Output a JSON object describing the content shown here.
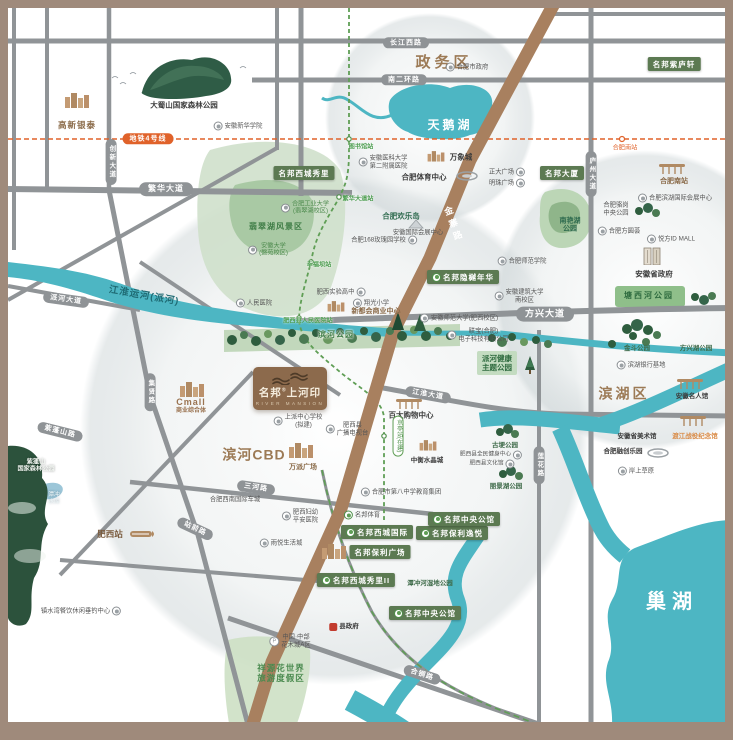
{
  "colors": {
    "frame": "#9f8a7b",
    "water": "#4db6c3",
    "park": "#cfe0cb",
    "tree": "#2e5d3e",
    "road": "#909497",
    "highway_brown": "#a8805f",
    "metro_orange": "#e0622a",
    "metro_green": "#5f9e55",
    "brand_label_green": "#5c7a52",
    "district_brown": "#9c7a55",
    "logo_plate": "#8c6a4c"
  },
  "logo": {
    "brand": "名邦",
    "mark": "®",
    "name": "上河印",
    "en": "RIVER MANSION"
  },
  "pois": [
    {
      "id": "gaoxin-intime-label",
      "t": "高新银泰",
      "x": 77,
      "y": 125,
      "cls": "brown-sm"
    },
    {
      "id": "dashushan-forest-label",
      "t": "大蜀山国家森林公园",
      "x": 184,
      "y": 105,
      "cls": "dark-sm"
    },
    {
      "id": "anhui-xinhua-college-label",
      "t": "安徽新华学院",
      "x": 238,
      "y": 126,
      "cls": "tiny",
      "icon": "p"
    },
    {
      "id": "metro-line4-pill",
      "t": "地铁4号线",
      "x": 148,
      "y": 139,
      "cls": "pill orange sm"
    },
    {
      "id": "fanhua-avenue-pill",
      "t": "繁华大道",
      "x": 166,
      "y": 189,
      "cls": "pill"
    },
    {
      "id": "chuangxin-avenue-pill",
      "t": "创新大道",
      "x": 111,
      "y": 162,
      "cls": "pill vert sm"
    },
    {
      "id": "mingbang-xicheng-xiuli-label",
      "t": "名邦西城秀里",
      "x": 304,
      "y": 173,
      "cls": "glabel"
    },
    {
      "id": "changjiang-west-road-pill",
      "t": "长江西路",
      "x": 406,
      "y": 43,
      "cls": "pill sm"
    },
    {
      "id": "zhengwu-district-label",
      "t": "政务区",
      "x": 444,
      "y": 63,
      "cls": "district"
    },
    {
      "id": "hefei-city-gov-label",
      "t": "合肥市政府",
      "x": 467,
      "y": 67,
      "cls": "tiny",
      "icon": "p"
    },
    {
      "id": "south-2nd-ring-pill",
      "t": "南二环路",
      "x": 404,
      "y": 80,
      "cls": "pill sm"
    },
    {
      "id": "swan-lake-label",
      "t": "天鹅湖",
      "x": 450,
      "y": 125,
      "cls": "lake-big"
    },
    {
      "id": "library-station-label",
      "t": "图书馆站",
      "x": 361,
      "y": 147,
      "cls": "st-g"
    },
    {
      "id": "anyida-no2-hospital-label",
      "t": [
        "安徽医科大学",
        "第二附属医院"
      ],
      "x": 383,
      "y": 162,
      "cls": "tiny",
      "icon": "p"
    },
    {
      "id": "mixc-label",
      "t": "万象城",
      "x": 461,
      "y": 157,
      "cls": "dark-sm"
    },
    {
      "id": "hefei-sports-center-label",
      "t": "合肥体育中心",
      "x": 424,
      "y": 177,
      "cls": "dark-sm"
    },
    {
      "id": "zhengda-plaza-label",
      "t": "正大广场",
      "x": 507,
      "y": 172,
      "cls": "tiny",
      "icon": "p",
      "ir": 1
    },
    {
      "id": "mingzhu-plaza-label",
      "t": "明珠广场",
      "x": 507,
      "y": 183,
      "cls": "tiny",
      "icon": "p",
      "ir": 1
    },
    {
      "id": "mingbang-mansion-label",
      "t": "名邦大厦",
      "x": 562,
      "y": 173,
      "cls": "glabel"
    },
    {
      "id": "mingbang-ziluxuan-label",
      "t": "名邦紫庐轩",
      "x": 674,
      "y": 64,
      "cls": "glabel"
    },
    {
      "id": "hefei-south-metro-station-label",
      "t": "合肥南站",
      "x": 625,
      "y": 148,
      "cls": "st-o"
    },
    {
      "id": "hefei-south-railway-label",
      "t": "合肥南站",
      "x": 674,
      "y": 182,
      "cls": "brown-sm2"
    },
    {
      "id": "luzhou-avenue-pill",
      "t": "庐州大道",
      "x": 591,
      "y": 174,
      "cls": "pill vert sm"
    },
    {
      "id": "fanhua-avenue-station-label",
      "t": "繁华大道站",
      "x": 358,
      "y": 199,
      "cls": "st-g"
    },
    {
      "id": "hfut-label",
      "t": [
        "合肥工业大学",
        "(翡翠湖校区)"
      ],
      "x": 305,
      "y": 208,
      "cls": "green-sm",
      "icon": "p"
    },
    {
      "id": "feicui-lake-scenic-label",
      "t": "翡翠湖风景区",
      "x": 276,
      "y": 227,
      "cls": "park-md"
    },
    {
      "id": "anhui-university-label",
      "t": [
        "安徽大学",
        "(磬苑校区)"
      ],
      "x": 268,
      "y": 250,
      "cls": "green-sm",
      "icon": "p"
    },
    {
      "id": "hefei-happy-island-label",
      "t": "合肥欢乐岛",
      "x": 401,
      "y": 216,
      "cls": "dark-green-sm"
    },
    {
      "id": "anhui-intl-expo-label",
      "t": "安徽国际会展中心",
      "x": 418,
      "y": 233,
      "cls": "tiny"
    },
    {
      "id": "hefei-168-rose-school-label",
      "t": "合肥168玫瑰园学校",
      "x": 384,
      "y": 240,
      "cls": "tiny",
      "icon": "p",
      "ir": 1
    },
    {
      "id": "jinzhai-road-label",
      "t": "金寨路",
      "x": 453,
      "y": 225,
      "cls": "hwy-label",
      "rot": -20
    },
    {
      "id": "jianghuai-canal-label",
      "t": "江淮运河(派河)",
      "x": 144,
      "y": 296,
      "cls": "canal-label",
      "rot": 10
    },
    {
      "id": "paihe-avenue-pill",
      "t": "派河大道",
      "x": 66,
      "y": 300,
      "cls": "pill sm",
      "rot": 8
    },
    {
      "id": "peoples-hospital-label",
      "t": "人民医院",
      "x": 254,
      "y": 303,
      "cls": "tiny",
      "icon": "p"
    },
    {
      "id": "xingfuba-station-label",
      "t": "幸福坝站",
      "x": 319,
      "y": 265,
      "cls": "st-g"
    },
    {
      "id": "feixi-experimental-hs-label",
      "t": "肥西实验高中",
      "x": 341,
      "y": 292,
      "cls": "tiny",
      "icon": "p",
      "ir": 1
    },
    {
      "id": "xiangguang-primary-label",
      "t": "翔光小学",
      "x": 371,
      "y": 303,
      "cls": "tiny",
      "icon": "p"
    },
    {
      "id": "xinduhui-commercial-label",
      "t": "新都会商业中心",
      "x": 376,
      "y": 312,
      "cls": "brown-sm2"
    },
    {
      "id": "feixi-peoples-hospital-station-label",
      "t": "肥西县人民医院站",
      "x": 308,
      "y": 321,
      "cls": "st-g tiny2"
    },
    {
      "id": "binhe-park-label",
      "t": "滨河公园",
      "x": 336,
      "y": 335,
      "cls": "park-md shadow"
    },
    {
      "id": "mingbang-yinyue-nianhua-label",
      "t": "名邦隐樾年华",
      "x": 463,
      "y": 277,
      "cls": "glabel",
      "icon": "m"
    },
    {
      "id": "hefei-normal-college-label",
      "t": "合肥师范学院",
      "x": 522,
      "y": 261,
      "cls": "tiny",
      "icon": "p"
    },
    {
      "id": "anhui-jianzhu-univ-label",
      "t": [
        "安徽建筑大学",
        "南校区"
      ],
      "x": 519,
      "y": 296,
      "cls": "tiny",
      "icon": "p"
    },
    {
      "id": "anhui-normal-univ-label",
      "t": "安徽师范大学(肥西校区)",
      "x": 459,
      "y": 318,
      "cls": "tiny",
      "icon": "p"
    },
    {
      "id": "lianbao-lenovo-label",
      "t": [
        "联宝(合肥)",
        "电子科技有限公司"
      ],
      "x": 478,
      "y": 335,
      "cls": "tiny",
      "icon": "p"
    },
    {
      "id": "fangxing-avenue-pill",
      "t": "方兴大道",
      "x": 545,
      "y": 314,
      "cls": "pill lg"
    },
    {
      "id": "paihe-health-park-label",
      "t": [
        "派河健康",
        "主题公园"
      ],
      "x": 497,
      "y": 363,
      "cls": "park-box"
    },
    {
      "id": "binhu-expo-center-label",
      "t": "合肥滨湖国际会展中心",
      "x": 675,
      "y": 198,
      "cls": "tiny",
      "icon": "p"
    },
    {
      "id": "luogang-central-park-label",
      "t": [
        "合肥骆岗",
        "中央公园"
      ],
      "x": 616,
      "y": 209,
      "cls": "tiny"
    },
    {
      "id": "nanyanhu-park-label",
      "t": [
        "南艳湖",
        "公园"
      ],
      "x": 570,
      "y": 226,
      "cls": "park-sm"
    },
    {
      "id": "fangyuanhui-label",
      "t": "合肥方圆荟",
      "x": 619,
      "y": 231,
      "cls": "tiny",
      "icon": "p"
    },
    {
      "id": "idmall-label",
      "t": "悦方ID MALL",
      "x": 671,
      "y": 239,
      "cls": "tiny",
      "icon": "p"
    },
    {
      "id": "anhui-prov-gov-label",
      "t": "安徽省政府",
      "x": 654,
      "y": 274,
      "cls": "dark-sm"
    },
    {
      "id": "tangxihe-park-label",
      "t": "塘西河公园",
      "x": 649,
      "y": 296,
      "cls": "park-on-green"
    },
    {
      "id": "jindou-park-label",
      "t": "金斗公园",
      "x": 637,
      "y": 349,
      "cls": "park-sm2"
    },
    {
      "id": "fangxinghu-park-label",
      "t": "方兴湖公园",
      "x": 696,
      "y": 349,
      "cls": "park-sm2"
    },
    {
      "id": "binhu-bank-base-label",
      "t": "滨湖银行基地",
      "x": 641,
      "y": 365,
      "cls": "tiny",
      "icon": "p"
    },
    {
      "id": "binhu-district-label",
      "t": "滨湖区",
      "x": 624,
      "y": 394,
      "cls": "district md"
    },
    {
      "id": "anhui-celebrity-hall-label",
      "t": "安徽名人馆",
      "x": 692,
      "y": 397,
      "cls": "tiny2b"
    },
    {
      "id": "anhui-art-museum-label",
      "t": "安徽省美术馆",
      "x": 637,
      "y": 437,
      "cls": "tiny2b"
    },
    {
      "id": "dujiang-memorial-label",
      "t": "渡江战役纪念馆",
      "x": 695,
      "y": 437,
      "cls": "orange-sm"
    },
    {
      "id": "hefei-sunac-park-label",
      "t": "合肥融创乐园",
      "x": 623,
      "y": 452,
      "cls": "tiny2b"
    },
    {
      "id": "anshang-caoyuan-label",
      "t": "岸上草原",
      "x": 636,
      "y": 471,
      "cls": "tiny",
      "icon": "p"
    },
    {
      "id": "lianhua-road-pill",
      "t": "莲花路",
      "x": 539,
      "y": 465,
      "cls": "pill vert sm"
    },
    {
      "id": "gugeng-park-label",
      "t": "古埂公园",
      "x": 505,
      "y": 446,
      "cls": "park-sm2"
    },
    {
      "id": "feixi-fitness-center-label",
      "t": "肥西县全民健身中心",
      "x": 491,
      "y": 455,
      "cls": "tiny tiny2",
      "icon": "p",
      "ir": 1
    },
    {
      "id": "feixi-culture-hall-label",
      "t": "肥西县文化馆",
      "x": 492,
      "y": 464,
      "cls": "tiny tiny2",
      "icon": "p",
      "ir": 1
    },
    {
      "id": "lijinghu-park-label",
      "t": "丽景湖公园",
      "x": 506,
      "y": 487,
      "cls": "park-sm2"
    },
    {
      "id": "cmall-label",
      "t": [
        "Cmall",
        "商业综合体"
      ],
      "x": 191,
      "y": 406,
      "cls": "brown-cmall"
    },
    {
      "id": "shangpai-school-label",
      "t": [
        "上派中心学校",
        "(拟建)"
      ],
      "x": 298,
      "y": 421,
      "cls": "tiny",
      "icon": "p"
    },
    {
      "id": "feixi-tv-station-label",
      "t": [
        "肥西县",
        "广播电视台"
      ],
      "x": 347,
      "y": 429,
      "cls": "tiny",
      "icon": "p"
    },
    {
      "id": "binhe-cbd-label",
      "t": "滨河CBD",
      "x": 254,
      "y": 455,
      "cls": "district md2"
    },
    {
      "id": "wanpai-plaza-label",
      "t": "万派广场",
      "x": 303,
      "y": 468,
      "cls": "brown-sm2"
    },
    {
      "id": "baida-mall-label",
      "t": "百大购物中心",
      "x": 411,
      "y": 415,
      "cls": "dark-sm"
    },
    {
      "id": "jingting-station-pill",
      "t": "京亭站(在建)",
      "x": 398,
      "y": 436,
      "cls": "st-pill"
    },
    {
      "id": "zhongheng-crystal-city-label",
      "t": "中衡水晶城",
      "x": 427,
      "y": 461,
      "cls": "tiny2b"
    },
    {
      "id": "jianghuai-avenue-pill",
      "t": "江淮大道",
      "x": 428,
      "y": 395,
      "cls": "pill sm",
      "rot": 10
    },
    {
      "id": "sanhe-road-pill",
      "t": "三河路",
      "x": 256,
      "y": 488,
      "cls": "pill sm",
      "rot": 8
    },
    {
      "id": "hefei-sw-auto-city-label",
      "t": "合肥西南国际车城",
      "x": 235,
      "y": 500,
      "cls": "tiny"
    },
    {
      "id": "hefei-no8-school-label",
      "t": "合肥市第八中学教育集团",
      "x": 401,
      "y": 492,
      "cls": "tiny",
      "icon": "p"
    },
    {
      "id": "feixi-maternity-hospital-label",
      "t": [
        "肥西妇幼",
        "平安医院"
      ],
      "x": 300,
      "y": 516,
      "cls": "tiny",
      "icon": "p"
    },
    {
      "id": "mingbang-sports-label",
      "t": "名邦体育",
      "x": 362,
      "y": 515,
      "cls": "tiny",
      "icon": "m"
    },
    {
      "id": "mingbang-xicheng-intl-label",
      "t": "名邦西城国际",
      "x": 377,
      "y": 532,
      "cls": "glabel",
      "icon": "m"
    },
    {
      "id": "mingbang-baoli-yiyue-label",
      "t": "名邦保利逸悦",
      "x": 452,
      "y": 533,
      "cls": "glabel",
      "icon": "m"
    },
    {
      "id": "mingbang-central-mansion-north-label",
      "t": "名邦中央公馆",
      "x": 464,
      "y": 519,
      "cls": "glabel",
      "icon": "m"
    },
    {
      "id": "mingbang-baoli-plaza-label",
      "t": "名邦保利广场",
      "x": 380,
      "y": 552,
      "cls": "glabel"
    },
    {
      "id": "yuyue-life-city-label",
      "t": "雨悦生活城",
      "x": 281,
      "y": 543,
      "cls": "tiny",
      "icon": "p"
    },
    {
      "id": "mingbang-xicheng-xiuli2-label",
      "t": "名邦西城秀里II",
      "x": 356,
      "y": 580,
      "cls": "glabel",
      "icon": "m"
    },
    {
      "id": "tanchong-wetland-park-label",
      "t": "潭冲河湿地公园",
      "x": 430,
      "y": 584,
      "cls": "park-sm2"
    },
    {
      "id": "mingbang-central-mansion-south-label",
      "t": "名邦中央公馆",
      "x": 425,
      "y": 613,
      "cls": "glabel",
      "icon": "m"
    },
    {
      "id": "county-gov-label",
      "t": "县政府",
      "x": 344,
      "y": 627,
      "cls": "tiny2b",
      "icon": "gov"
    },
    {
      "id": "china-flower-city-label",
      "t": [
        "中国·中部",
        "花木城A区"
      ],
      "x": 290,
      "y": 641,
      "cls": "tiny",
      "icon": "pk"
    },
    {
      "id": "xiangyuan-flower-world-label",
      "t": [
        "祥源花世界",
        "旅游度假区"
      ],
      "x": 281,
      "y": 673,
      "cls": "park-lg"
    },
    {
      "id": "zhenshuiwan-label",
      "t": "镇水湾餐饮休闲垂钓中心",
      "x": 81,
      "y": 611,
      "cls": "tiny",
      "icon": "p",
      "ir": 1
    },
    {
      "id": "feixi-station-label",
      "t": "肥西站",
      "x": 110,
      "y": 534,
      "cls": "brown-md"
    },
    {
      "id": "zipengshan-forest-label",
      "t": [
        "紫蓬山",
        "国家森林公园"
      ],
      "x": 36,
      "y": 466,
      "cls": "white-xs"
    },
    {
      "id": "tanchong-reservoir-label",
      "t": [
        "潭冲",
        "水库"
      ],
      "x": 54,
      "y": 499,
      "cls": "white-xs2"
    },
    {
      "id": "zipengshan-road-pill",
      "t": "紫蓬山路",
      "x": 60,
      "y": 432,
      "cls": "pill sm",
      "rot": 14
    },
    {
      "id": "jixian-road-pill",
      "t": "集贤路",
      "x": 150,
      "y": 392,
      "cls": "pill vert sm"
    },
    {
      "id": "zhanqian-road-pill",
      "t": "站前路",
      "x": 195,
      "y": 529,
      "cls": "pill sm",
      "rot": 25
    },
    {
      "id": "hetong-road-pill",
      "t": "合铜路",
      "x": 422,
      "y": 675,
      "cls": "pill sm",
      "rot": 18
    },
    {
      "id": "chaohu-lake-label",
      "t": "巢湖",
      "x": 672,
      "y": 602,
      "cls": "lake-huge"
    }
  ],
  "icons": [
    {
      "id": "gaoxin-intime-icon",
      "icon": "bld",
      "x": 77,
      "y": 100
    },
    {
      "id": "mixc-icon",
      "icon": "bld",
      "x": 436,
      "y": 156,
      "s": 1
    },
    {
      "id": "sports-center-stadium-icon",
      "icon": "stad",
      "x": 467,
      "y": 176
    },
    {
      "id": "hefei-south-railway-icon",
      "icon": "pav",
      "x": 672,
      "y": 169
    },
    {
      "id": "expo-tent-icon",
      "icon": "tent",
      "x": 416,
      "y": 224
    },
    {
      "id": "xinduhui-buildings-icon",
      "icon": "bld",
      "x": 336,
      "y": 306,
      "s": 1
    },
    {
      "id": "anhui-gov-building-icon",
      "icon": "bld2",
      "x": 652,
      "y": 256
    },
    {
      "id": "celebrity-hall-pavilion-icon",
      "icon": "pav",
      "x": 690,
      "y": 384
    },
    {
      "id": "dujiang-memorial-icon",
      "icon": "pav",
      "x": 693,
      "y": 421
    },
    {
      "id": "sunac-stadium-icon",
      "icon": "stad",
      "x": 658,
      "y": 453
    },
    {
      "id": "cmall-buildings-icon",
      "icon": "bld",
      "x": 192,
      "y": 389
    },
    {
      "id": "wanpai-buildings-icon",
      "icon": "bld",
      "x": 301,
      "y": 450
    },
    {
      "id": "baida-mall-icon",
      "icon": "pav",
      "x": 409,
      "y": 404
    },
    {
      "id": "crystal-city-towers-icon",
      "icon": "bld",
      "x": 428,
      "y": 445,
      "s": 1
    },
    {
      "id": "baoli-plaza-buildings-icon",
      "icon": "bld",
      "x": 334,
      "y": 551
    },
    {
      "id": "feixi-train-icon",
      "icon": "train",
      "x": 142,
      "y": 534
    },
    {
      "id": "health-park-tree-icon",
      "icon": "tree",
      "x": 530,
      "y": 365
    }
  ]
}
